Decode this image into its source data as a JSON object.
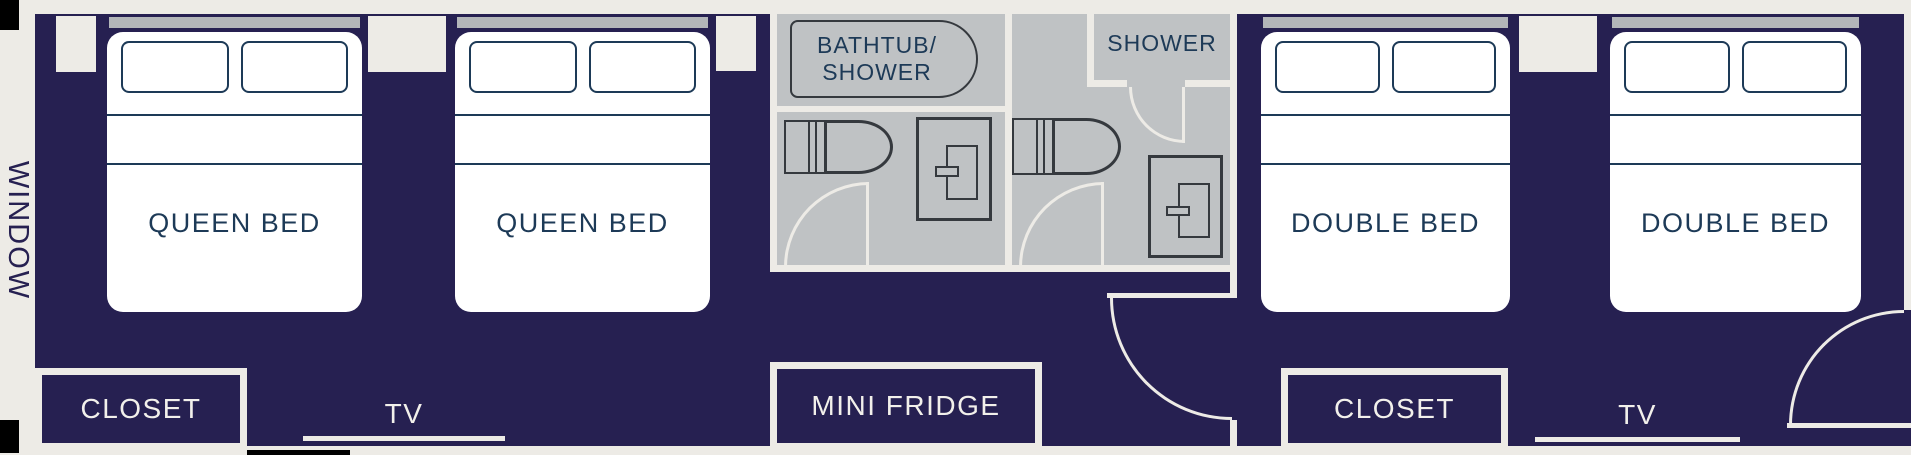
{
  "colors": {
    "navy": "#262051",
    "wall": "#edebe6",
    "white": "#ffffff",
    "bathfloor": "#bfc2c4",
    "headboard": "#b3b6b9",
    "line": "#1d3a57",
    "fixture": "#35393e",
    "lightlabel": "#f2f0eb",
    "black": "#000000"
  },
  "labels": {
    "window": "WINDOW",
    "left_room": {
      "bed1": "QUEEN BED",
      "bed2": "QUEEN BED",
      "closet": "CLOSET",
      "tv": "TV"
    },
    "right_room": {
      "bed1": "DOUBLE BED",
      "bed2": "DOUBLE BED",
      "closet": "CLOSET",
      "tv": "TV"
    },
    "bathroom1": {
      "tub_line1": "BATHTUB/",
      "tub_line2": "SHOWER"
    },
    "bathroom2": {
      "shower": "SHOWER"
    },
    "mini_fridge": "MINI FRIDGE"
  }
}
